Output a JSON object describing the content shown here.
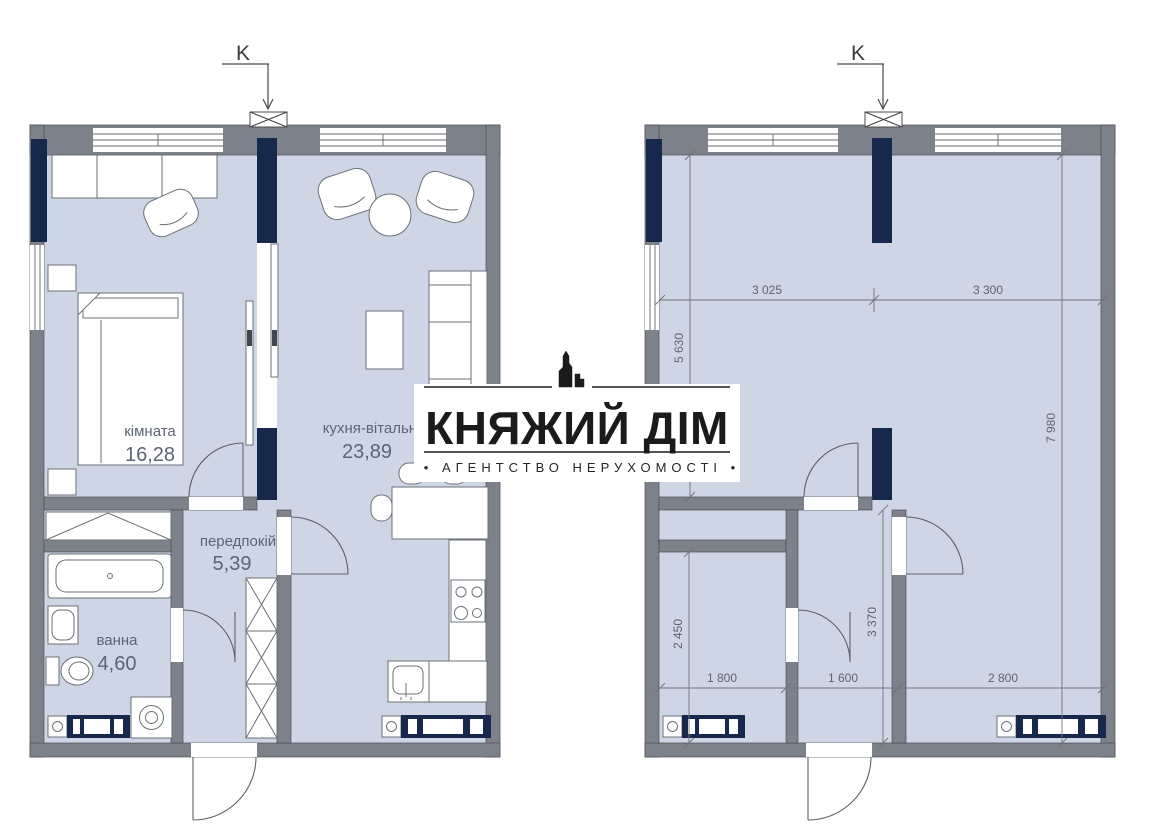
{
  "logo": {
    "title": "КНЯЖИЙ ДІМ",
    "subtitle": "• АГЕНТСТВО НЕРУХОМОСТІ •"
  },
  "plans": {
    "left": {
      "k_marker": "K",
      "rooms": {
        "bedroom": {
          "name": "кімната",
          "area": "16,28"
        },
        "kitchen_living": {
          "name": "кухня-вітальня",
          "area": "23,89"
        },
        "hallway": {
          "name": "передпокій",
          "area": "5,39"
        },
        "bathroom": {
          "name": "ванна",
          "area": "4,60"
        }
      }
    },
    "right": {
      "k_marker": "K",
      "dimensions": {
        "width_bedroom": "3 025",
        "width_living": "3 300",
        "height_bedroom": "5 630",
        "height_living": "7 980",
        "height_bathroom": "2 450",
        "height_hallway": "3 370",
        "width_bathroom": "1 800",
        "width_hallway": "1 600",
        "width_window_zone": "2 800"
      }
    }
  },
  "colors": {
    "floor": "#ced6e6",
    "wall": "#7d828a",
    "accent_navy": "#16294d",
    "label_text": "#5c6476",
    "logo_text": "#1b1b1b"
  }
}
